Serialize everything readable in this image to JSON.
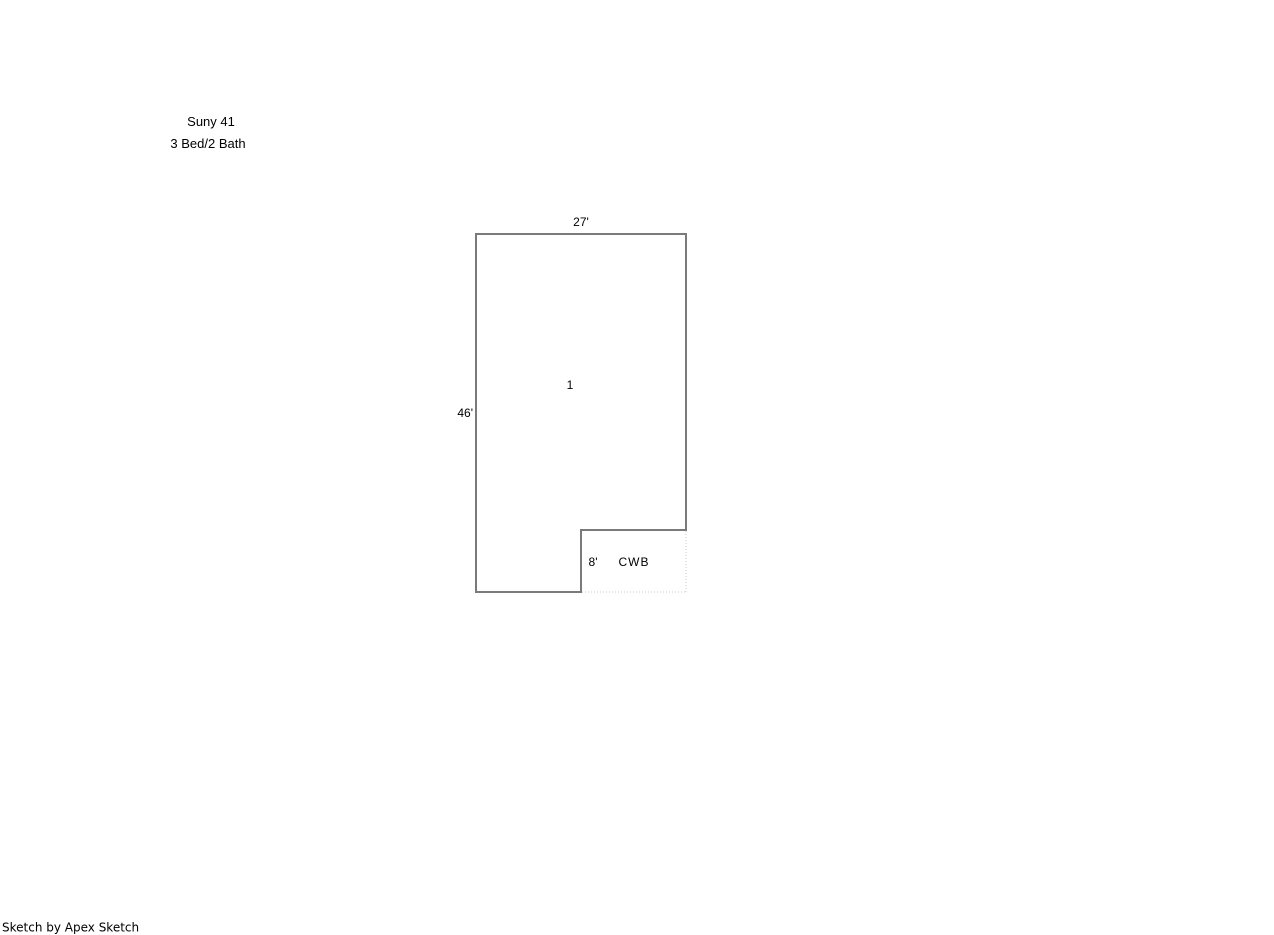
{
  "header": {
    "title": "Suny 41",
    "subtitle": "3 Bed/2 Bath"
  },
  "floorplan": {
    "area1": {
      "label": "1",
      "width_dim": "27'",
      "height_dim": "46'"
    },
    "area2": {
      "label": "CWB",
      "height_dim": "8'"
    }
  },
  "footer": {
    "credit": "Sketch by Apex Sketch"
  },
  "colors": {
    "outline": "#7a7a7a",
    "dotted_edge": "#c9c9c9",
    "text": "#000000",
    "background": "#ffffff"
  }
}
